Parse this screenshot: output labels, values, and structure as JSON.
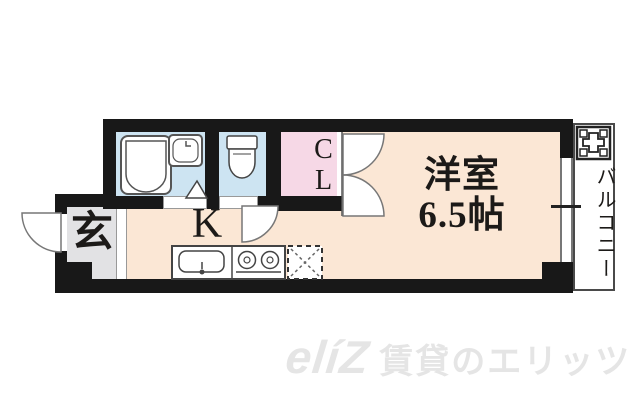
{
  "floorplan": {
    "entrance": {
      "label": "玄"
    },
    "kitchen": {
      "label": "K"
    },
    "closet": {
      "label": "CL"
    },
    "main_room": {
      "label": "洋室",
      "size": "6.5帖"
    },
    "balcony": {
      "label": "バルコニー"
    },
    "fixtures": {
      "bathtub": "bathtub",
      "washbasin": "washbasin",
      "toilet": "toilet",
      "kitchen_sink": "kitchen-sink",
      "stove": "two-burner-stove",
      "refrigerator_space": "refrigerator-space (dashed)",
      "washing_machine_space": "washing-machine-space"
    },
    "colors": {
      "wall": "#181818",
      "room_floor": "#fbe7d5",
      "wet_floor": "#cde4f2",
      "closet_floor": "#f6d8e6",
      "entrance_floor": "#e2e2e4"
    }
  },
  "watermark": {
    "logo": "elíZ",
    "text": "賃貸のエリッツ"
  }
}
